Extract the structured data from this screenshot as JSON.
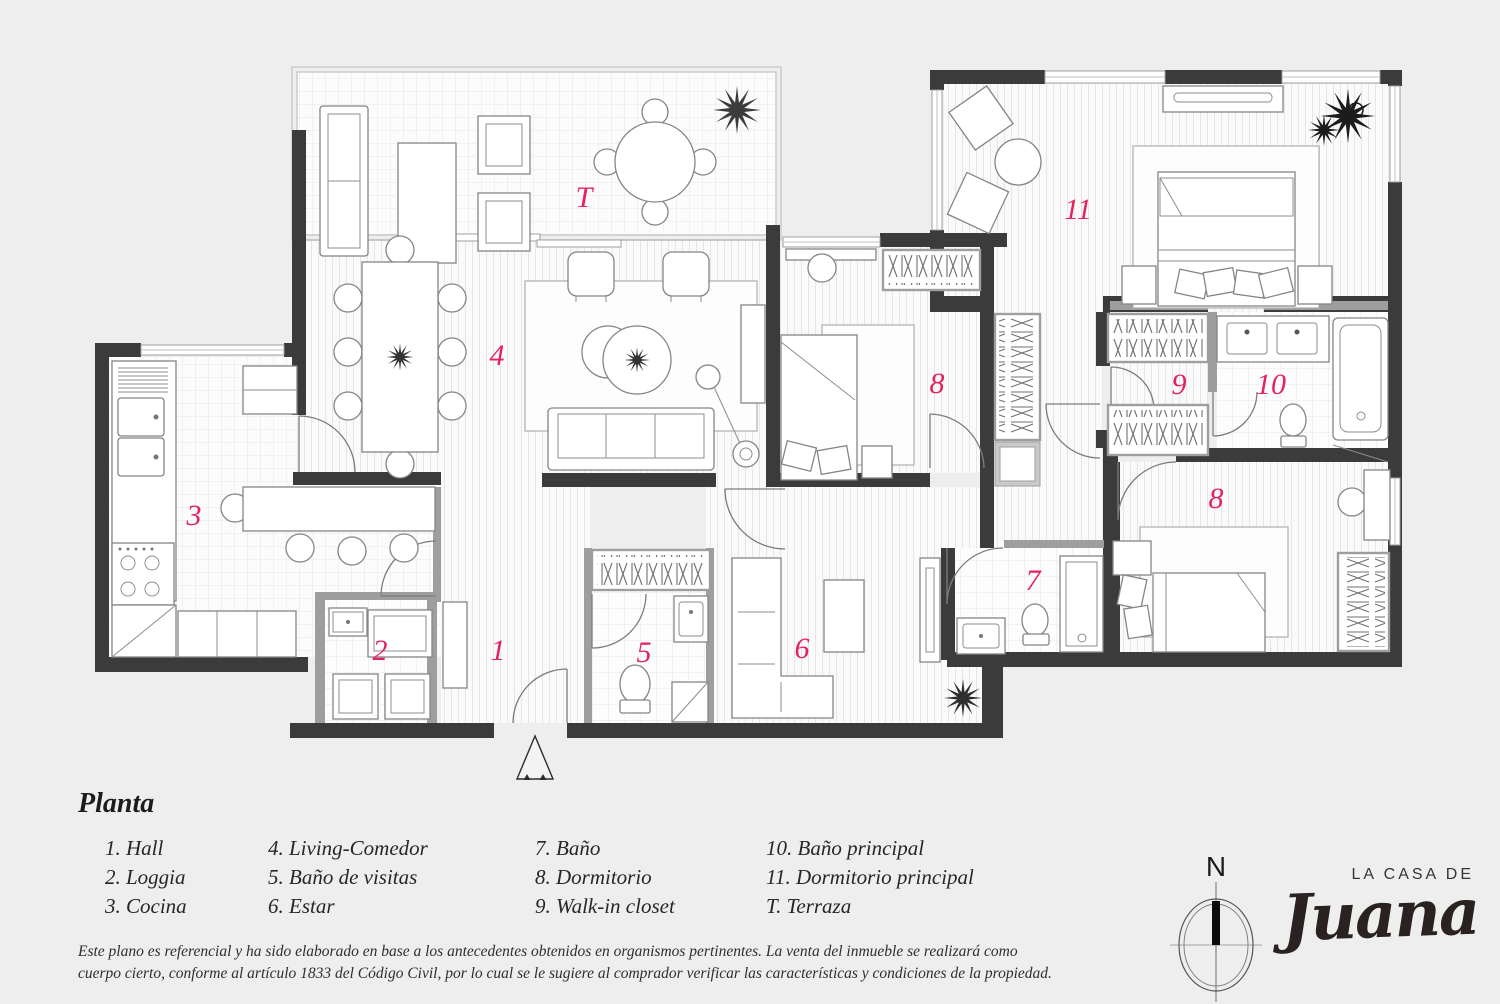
{
  "plan": {
    "accent_color": "#e5225e",
    "wall_color": "#3b3b3b",
    "labels": {
      "terraza": "T",
      "hall": "1",
      "loggia": "2",
      "cocina": "3",
      "living_comedor": "4",
      "bano_visitas": "5",
      "estar": "6",
      "bano": "7",
      "dormitorio_norte": "8",
      "dormitorio_este": "8",
      "walk_in_closet": "9",
      "bano_principal": "10",
      "dormitorio_principal": "11"
    }
  },
  "legend": {
    "title": "Planta",
    "columns": [
      {
        "items": [
          "1. Hall",
          "2. Loggia",
          "3. Cocina"
        ]
      },
      {
        "items": [
          "4. Living-Comedor",
          "5. Baño de visitas",
          "6. Estar"
        ]
      },
      {
        "items": [
          "7. Baño",
          "8. Dormitorio",
          "9. Walk-in closet"
        ]
      },
      {
        "items": [
          "10. Baño principal",
          "11. Dormitorio principal",
          "T. Terraza"
        ]
      }
    ]
  },
  "disclaimer": {
    "line1": "Este plano es referencial y ha sido elaborado en base a los antecedentes obtenidos en organismos pertinentes.  La venta del inmueble se realizará como",
    "line2": "cuerpo cierto, conforme al artículo 1833 del Código Civil, por lo cual se le sugiere al comprador verificar las características y condiciones de la propiedad."
  },
  "compass": {
    "north_label": "N"
  },
  "logo": {
    "line1": "LA CASA DE",
    "script": "Juana"
  }
}
